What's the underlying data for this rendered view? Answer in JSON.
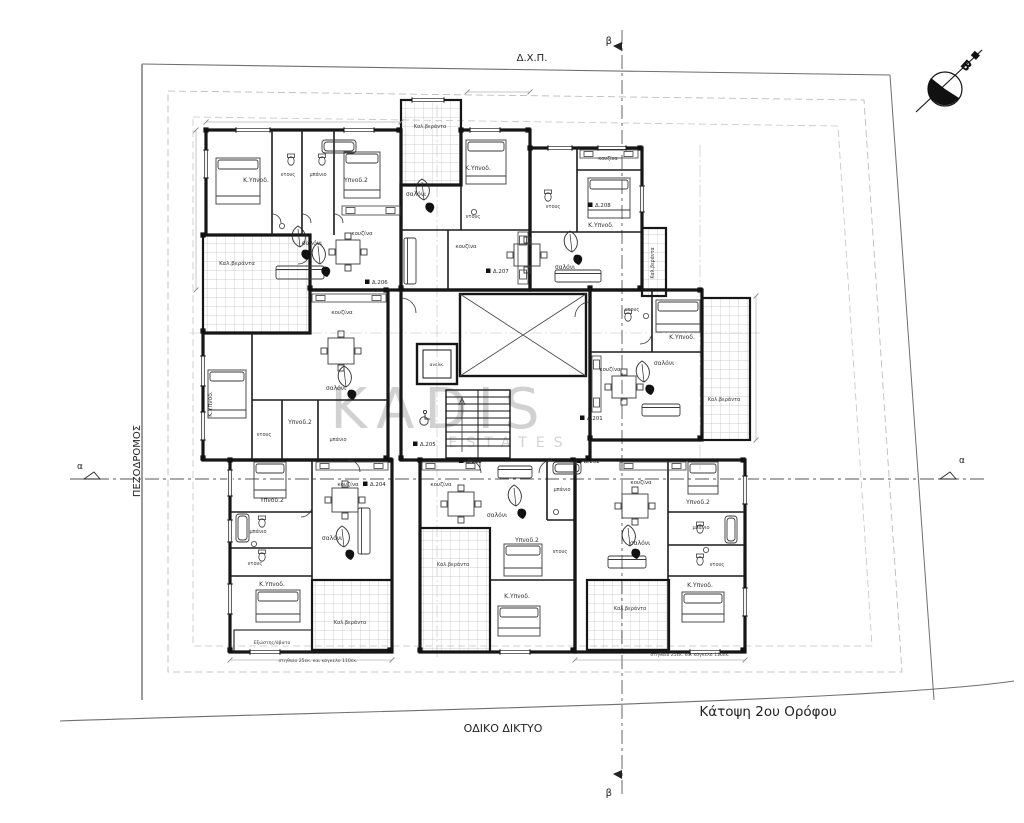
{
  "site": {
    "top_label": "Δ.Χ.Π.",
    "left_label": "ΠΕΖΟΔΡΟΜΟΣ",
    "bottom_label": "ΟΔΙΚΟ ΔΙΚΤΥΟ",
    "plan_title": "Κάτοψη 2ου Ορόφου"
  },
  "sections": {
    "vertical_top": "β",
    "vertical_bottom": "β",
    "horizontal_left": "α",
    "horizontal_right": "α"
  },
  "north": {
    "label": "Β"
  },
  "watermark": {
    "line1": "KADIS",
    "line2": "ESTATES"
  },
  "core": {
    "elevator_label": "ανελκ."
  },
  "colors": {
    "wall": "#161616",
    "tile_line": "#bdbdbd",
    "watermark": "#c6c6c6",
    "section_line": "#555555"
  },
  "notes": [
    {
      "text": "στηθαίο 25εκ. και κάγκελο 110εκ.",
      "x": 318,
      "y": 662
    },
    {
      "text": "στηθαίο 25εκ. και κάγκελο 110εκ.",
      "x": 690,
      "y": 656
    }
  ],
  "unit_tags": [
    {
      "t": "Δ.201",
      "x": 594,
      "y": 420
    },
    {
      "t": "Δ.202",
      "x": 591,
      "y": 463
    },
    {
      "t": "Δ.203",
      "x": 473,
      "y": 463
    },
    {
      "t": "Δ.204",
      "x": 377,
      "y": 486
    },
    {
      "t": "Δ.205",
      "x": 427,
      "y": 446
    },
    {
      "t": "Δ.206",
      "x": 379,
      "y": 284
    },
    {
      "t": "Δ.207",
      "x": 500,
      "y": 273
    },
    {
      "t": "Δ.208",
      "x": 602,
      "y": 207
    }
  ],
  "room_labels": [
    {
      "t": "Κ.Υπνοδ.",
      "x": 256,
      "y": 182
    },
    {
      "t": "ντους",
      "x": 288,
      "y": 176,
      "s": 5
    },
    {
      "t": "μπάνιο",
      "x": 318,
      "y": 176,
      "s": 5
    },
    {
      "t": "Υπνοδ.2",
      "x": 356,
      "y": 182
    },
    {
      "t": "σαλόνι",
      "x": 312,
      "y": 245
    },
    {
      "t": "κουζίνα",
      "x": 362,
      "y": 235,
      "s": 5.5
    },
    {
      "t": "Καλ.βεράντα",
      "x": 237,
      "y": 265,
      "s": 5.5
    },
    {
      "t": "Καλ.βεράντα",
      "x": 430,
      "y": 128,
      "s": 5
    },
    {
      "t": "Κ.Υπνοδ.",
      "x": 478,
      "y": 170
    },
    {
      "t": "σαλόνι",
      "x": 416,
      "y": 196
    },
    {
      "t": "ντους",
      "x": 473,
      "y": 218,
      "s": 5
    },
    {
      "t": "κουζίνα",
      "x": 466,
      "y": 248,
      "s": 5.5
    },
    {
      "t": "κουζίνα",
      "x": 608,
      "y": 160,
      "s": 5
    },
    {
      "t": "ντους",
      "x": 553,
      "y": 208,
      "s": 5
    },
    {
      "t": "Κ.Υπνοδ.",
      "x": 601,
      "y": 227
    },
    {
      "t": "σαλόνι",
      "x": 565,
      "y": 269
    },
    {
      "t": "Καλ.βεράντα",
      "x": 654,
      "y": 263,
      "s": 4.8,
      "r": -90
    },
    {
      "t": "ντους",
      "x": 632,
      "y": 311,
      "s": 5
    },
    {
      "t": "Κ.Υπνοδ.",
      "x": 682,
      "y": 339
    },
    {
      "t": "σαλόνι",
      "x": 664,
      "y": 365
    },
    {
      "t": "κουζίνα",
      "x": 610,
      "y": 371,
      "s": 5.5
    },
    {
      "t": "Καλ.βεράντα",
      "x": 724,
      "y": 401,
      "s": 5
    },
    {
      "t": "κουζίνα",
      "x": 342,
      "y": 314,
      "s": 5.5
    },
    {
      "t": "σαλόνι",
      "x": 336,
      "y": 390
    },
    {
      "t": "Κ.Υπνοδ.",
      "x": 212,
      "y": 404,
      "s": 6,
      "r": -90
    },
    {
      "t": "Υπνοδ.2",
      "x": 300,
      "y": 424
    },
    {
      "t": "ντους",
      "x": 264,
      "y": 436,
      "s": 5
    },
    {
      "t": "μπάνιο",
      "x": 338,
      "y": 441,
      "s": 5
    },
    {
      "t": "κουζίνα",
      "x": 348,
      "y": 486,
      "s": 5.5
    },
    {
      "t": "Υπνοδ.2",
      "x": 272,
      "y": 502
    },
    {
      "t": "μπάνιο",
      "x": 258,
      "y": 533,
      "s": 5
    },
    {
      "t": "σαλόνι",
      "x": 332,
      "y": 540
    },
    {
      "t": "ντους",
      "x": 255,
      "y": 565,
      "s": 5
    },
    {
      "t": "Κ.Υπνοδ.",
      "x": 272,
      "y": 586
    },
    {
      "t": "Καλ.βεράντα",
      "x": 350,
      "y": 624,
      "s": 5
    },
    {
      "t": "Εξώστης/άβατο",
      "x": 272,
      "y": 644,
      "s": 4.6
    },
    {
      "t": "κουζίνα",
      "x": 441,
      "y": 486,
      "s": 5.5
    },
    {
      "t": "σαλόνι",
      "x": 497,
      "y": 517
    },
    {
      "t": "μπάνιο",
      "x": 562,
      "y": 491,
      "s": 5
    },
    {
      "t": "Υπνοδ.2",
      "x": 527,
      "y": 542
    },
    {
      "t": "ντους",
      "x": 560,
      "y": 553,
      "s": 5
    },
    {
      "t": "Καλ.βεράντα",
      "x": 453,
      "y": 566,
      "s": 5
    },
    {
      "t": "Κ.Υπνοδ.",
      "x": 517,
      "y": 598
    },
    {
      "t": "κουζίνα",
      "x": 641,
      "y": 484,
      "s": 5.5
    },
    {
      "t": "Υπνοδ.2",
      "x": 698,
      "y": 504
    },
    {
      "t": "μπάνιο",
      "x": 701,
      "y": 529,
      "s": 5
    },
    {
      "t": "σαλόνι",
      "x": 640,
      "y": 545
    },
    {
      "t": "ντους",
      "x": 717,
      "y": 566,
      "s": 5
    },
    {
      "t": "Κ.Υπνοδ.",
      "x": 700,
      "y": 587
    },
    {
      "t": "Καλ.βεράντα",
      "x": 630,
      "y": 610,
      "s": 5
    }
  ]
}
